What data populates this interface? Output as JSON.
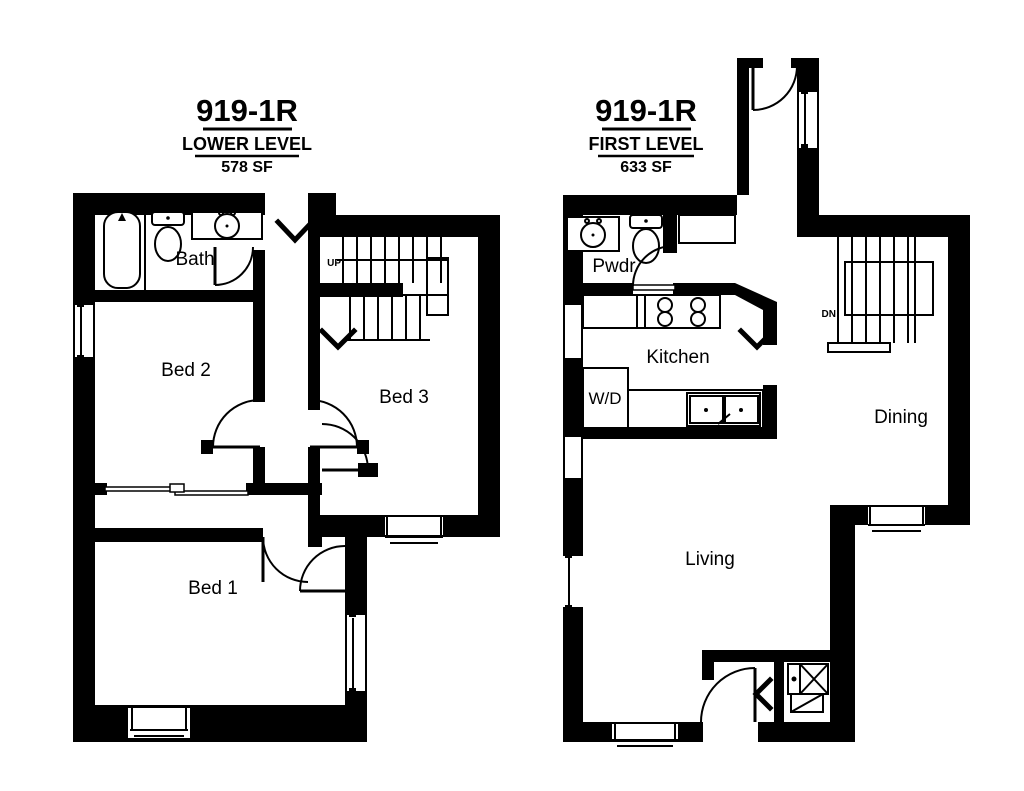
{
  "page": {
    "background": "#ffffff",
    "ink": "#000000"
  },
  "lower_level": {
    "unit": "919-1R",
    "level": "LOWER LEVEL",
    "area": "578 SF",
    "rooms": {
      "bath": "Bath",
      "bed2": "Bed 2",
      "bed3": "Bed 3",
      "bed1": "Bed 1"
    },
    "stair_direction": "UP"
  },
  "first_level": {
    "unit": "919-1R",
    "level": "FIRST LEVEL",
    "area": "633 SF",
    "rooms": {
      "pwdr": "Pwdr",
      "kitchen": "Kitchen",
      "laundry": "W/D",
      "dining": "Dining",
      "living": "Living"
    },
    "stair_direction": "DN"
  }
}
